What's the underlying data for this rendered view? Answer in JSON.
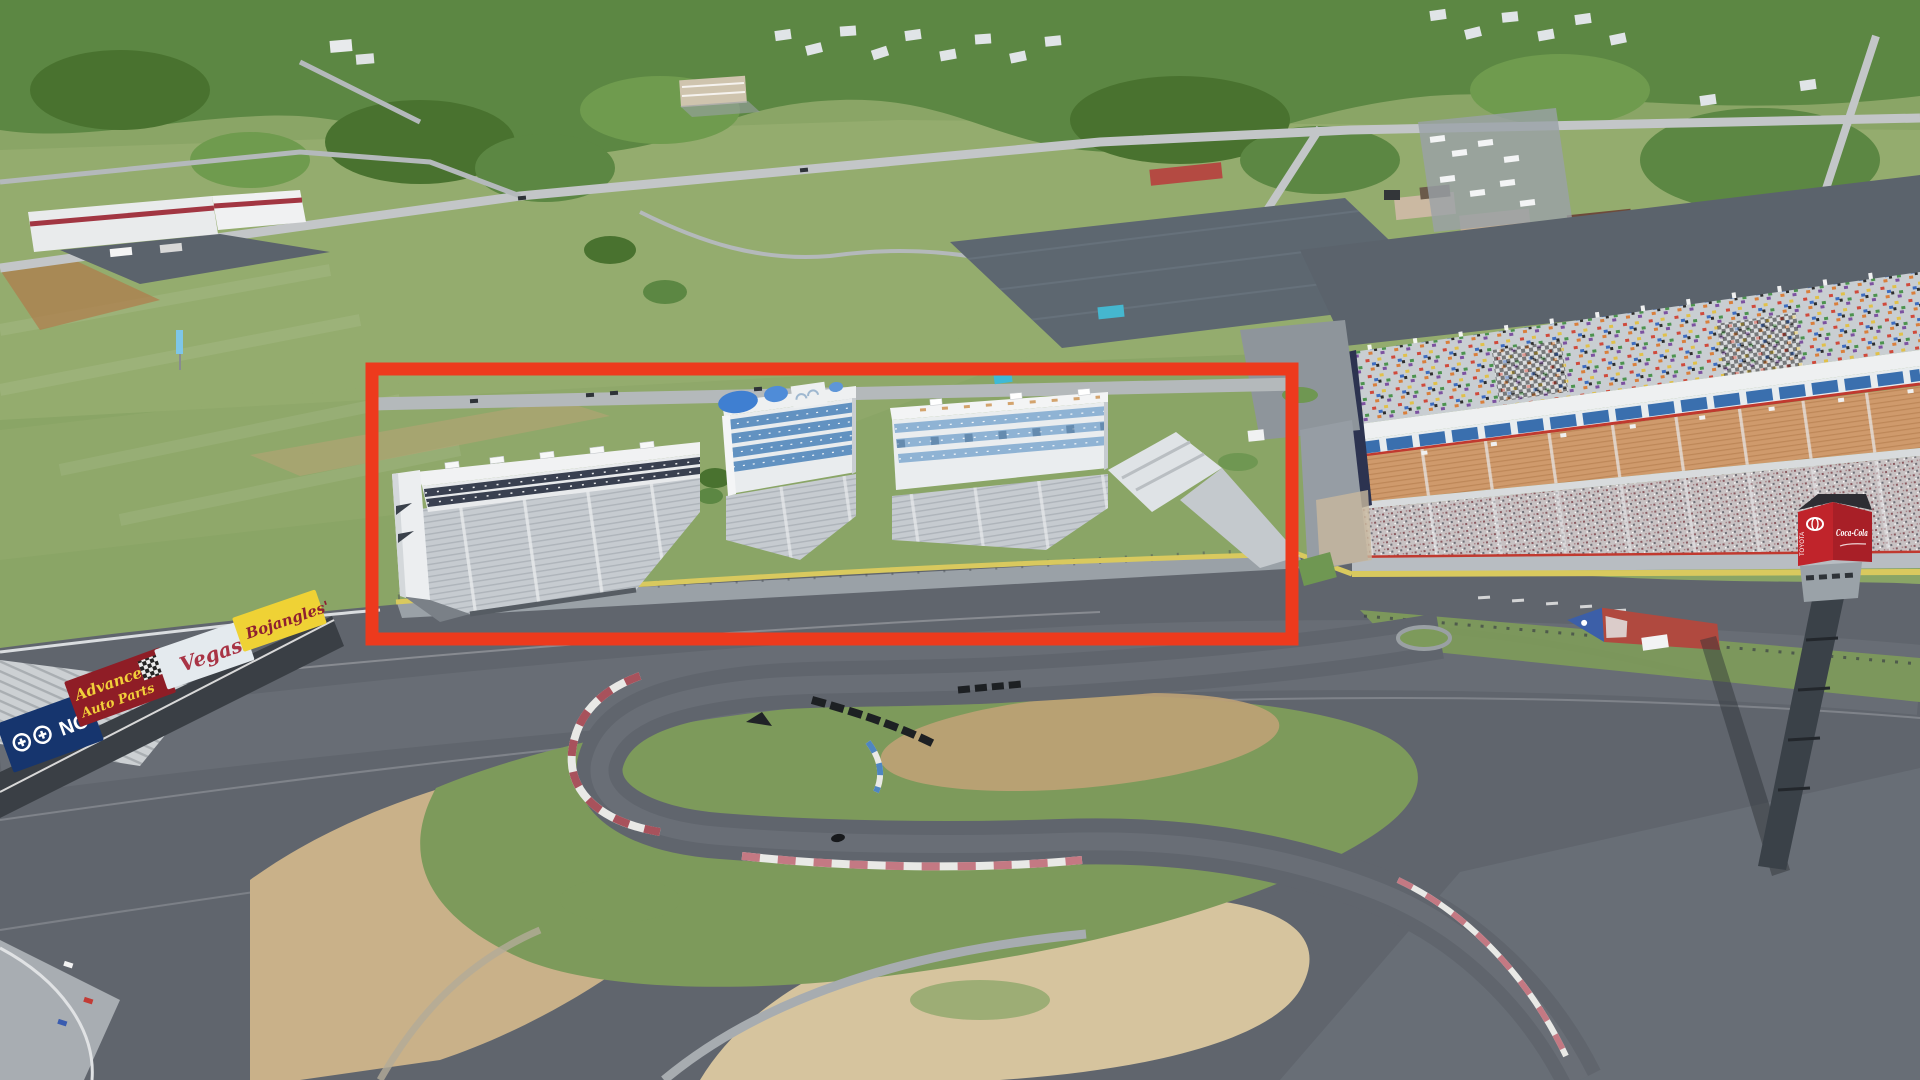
{
  "image": {
    "kind": "aerial-3d-satellite-view",
    "subject": "motor-speedway-with-grandstands-and-infield-road-course"
  },
  "annotation": {
    "shape": "rectangle",
    "color": "#ed3a1d",
    "x": 372,
    "y": 369,
    "width": 920,
    "height": 270,
    "stroke_width": 13
  },
  "trackside_billboards": [
    {
      "id": "blue-nc",
      "label": "NC",
      "bg_color": "#16356e",
      "text_color": "#ffffff"
    },
    {
      "id": "advance-auto-parts",
      "label": "Advance Auto Parts",
      "label_line1": "Advance",
      "label_line2": "Auto Parts",
      "bg_color": "#8f1d26",
      "text_color": "#f2cf3a"
    },
    {
      "id": "vegas",
      "label": "Vegas",
      "bg_color": "#e4eaee",
      "text_color": "#a93445"
    },
    {
      "id": "bojangles",
      "label": "Bojangles'",
      "bg_color": "#efd235",
      "text_color": "#8e2030"
    }
  ],
  "scoring_tower": {
    "cube_color": "#c0242b",
    "signs": [
      {
        "label": "TOYOTA"
      },
      {
        "label": "Coca-Cola"
      }
    ]
  },
  "colors": {
    "field": "#8aa566",
    "field_light": "#9db374",
    "tree": "#5c8743",
    "tree_dark": "#49722f",
    "tree_light": "#6f9b4e",
    "dirt_red": "#b07a4a",
    "sand": "#c9b189",
    "sand_light": "#d6c49e",
    "road": "#c3c6c8",
    "road_minor": "#b4b9bb",
    "lot": "#5d6770",
    "concourse": "#5b636c",
    "track": "#60656d",
    "track_light": "#787d85",
    "apron": "#9aa1a7",
    "infield_grass": "#7d9a5b",
    "bleacher": "#c6cbd0",
    "bleacher_line": "#aeb4ba",
    "white_building": "#eef0f2",
    "glass_blue": "#6292c1",
    "glass_light": "#8fb3d4",
    "dome_blue": "#3f7fd1",
    "seat_orange": "#cf9a6c",
    "seat_line": "#bd8758",
    "crowd_base": "#c8c2c3",
    "end_wall_navy": "#2c3350",
    "yellow_wall": "#d9c95e",
    "curb_red": "#a8525c",
    "curb_pink": "#c47983",
    "curb_white": "#e9e9e6",
    "curb_blue": "#4f86c0",
    "tire_black": "#1d2023",
    "shadow": "#3a3f45"
  }
}
